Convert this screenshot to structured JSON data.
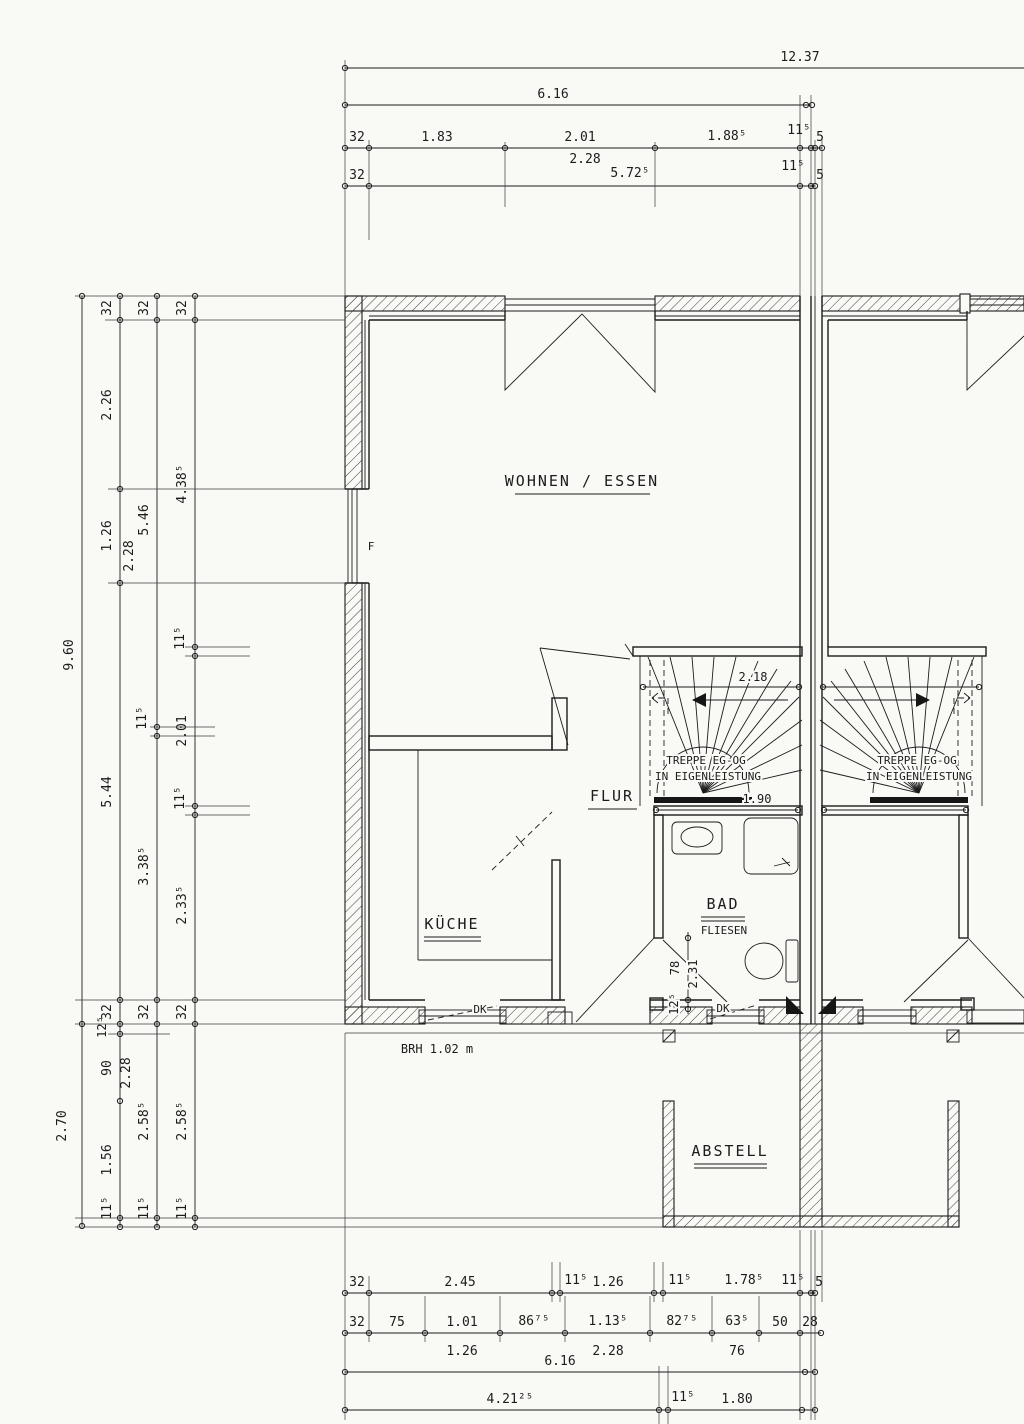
{
  "drawing": {
    "rooms": {
      "living": "WOHNEN / ESSEN",
      "kitchen": "KÜCHE",
      "hall": "FLUR",
      "bath": "BAD",
      "bath_finish": "FLIESEN",
      "storage": "ABSTELL",
      "stair_l1": "TREPPE EG-OG",
      "stair_l2": "IN EIGENLEISTUNG"
    },
    "notes": {
      "window_f": "F",
      "window_dk": "DK",
      "sill_height": "BRH 1.02 m"
    },
    "stair_dims": {
      "width": "2.18",
      "run": "1.90"
    },
    "bath_door_dims": {
      "offset": "12⁵",
      "door": "78",
      "total": "2.31"
    }
  },
  "dims": {
    "top": {
      "overall": "12.37",
      "inner": "6.16",
      "row3": [
        "32",
        "1.83",
        "2.01",
        "1.88⁵",
        "11⁵",
        "5"
      ],
      "row3_sub": "2.28",
      "row4": [
        "32",
        "5.72⁵",
        "11⁵",
        "5"
      ]
    },
    "left": {
      "overall": "9.60",
      "storage_depth": "2.70",
      "colB": [
        "32",
        "2.26",
        "1.26",
        "5.44"
      ],
      "colB_sub": "2.28",
      "colB_low": [
        "32",
        "12⁵",
        "90",
        "1.56",
        "11⁵"
      ],
      "colB_low_sub": "2.28",
      "colC": [
        "32",
        "5.46",
        "11⁵",
        "3.38⁵"
      ],
      "colC_low": [
        "32",
        "2.58⁵",
        "11⁵"
      ],
      "colD": [
        "32",
        "4.38⁵",
        "11⁵",
        "2.01",
        "11⁵",
        "2.33⁵"
      ],
      "colD_low": [
        "32",
        "2.58⁵",
        "11⁵"
      ]
    },
    "bottom": {
      "row1": [
        "32",
        "2.45",
        "11⁵",
        "1.26",
        "11⁵",
        "1.78⁵",
        "11⁵",
        "5"
      ],
      "row2": [
        "32",
        "75",
        "1.01",
        "86⁷⁵",
        "1.13⁵",
        "82⁷⁵",
        "63⁵",
        "50",
        "28"
      ],
      "row2_sub": [
        "1.26",
        "2.28",
        "76"
      ],
      "row3": "6.16",
      "row4": [
        "4.21²⁵",
        "11⁵",
        "1.80"
      ]
    }
  }
}
